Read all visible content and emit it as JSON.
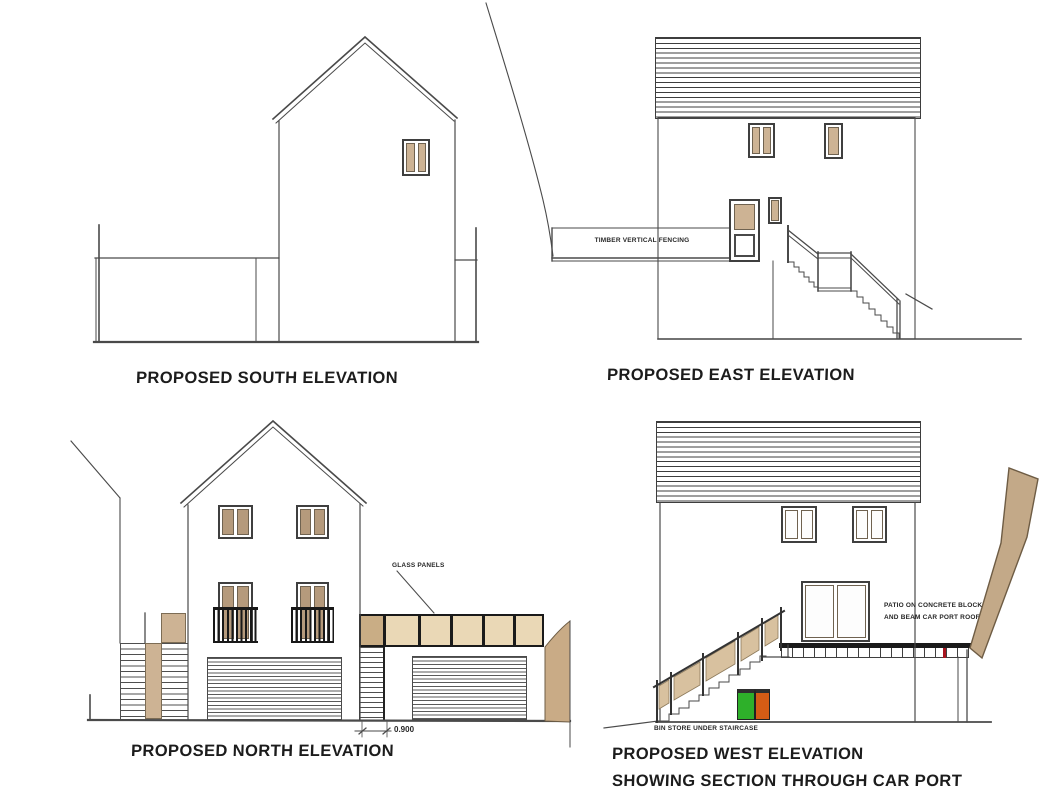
{
  "drawing": {
    "background": "#ffffff",
    "views": {
      "south": {
        "title": "PROPOSED SOUTH ELEVATION"
      },
      "east": {
        "title": "PROPOSED EAST ELEVATION",
        "fence_label": "TIMBER VERTICAL FENCING"
      },
      "north": {
        "title": "PROPOSED NORTH ELEVATION",
        "glass_panels_label": "GLASS PANELS",
        "pier_dimension": "0.900"
      },
      "west": {
        "title_line1": "PROPOSED WEST ELEVATION",
        "title_line2": "SHOWING SECTION THROUGH CAR PORT",
        "patio_note_line1": "PATIO ON CONCRETE BLOCK",
        "patio_note_line2": "AND BEAM CAR PORT ROOF",
        "bin_store_label": "BIN STORE UNDER STAIRCASE"
      }
    },
    "colors": {
      "line": "#4a4a4a",
      "window_glass_tan": "#cdb394",
      "window_glass_brown": "#b59a7c",
      "glass_panel_light": "#ead8b6",
      "glass_panel_dark": "#c9ad85",
      "timber_railing": "#d8c19f",
      "ground_section_tan": "#c3a988",
      "bin_green": "#2eb02a",
      "bin_orange": "#d55c15",
      "beam_black": "#1a1a1a",
      "marker_red": "#a8141f"
    }
  }
}
